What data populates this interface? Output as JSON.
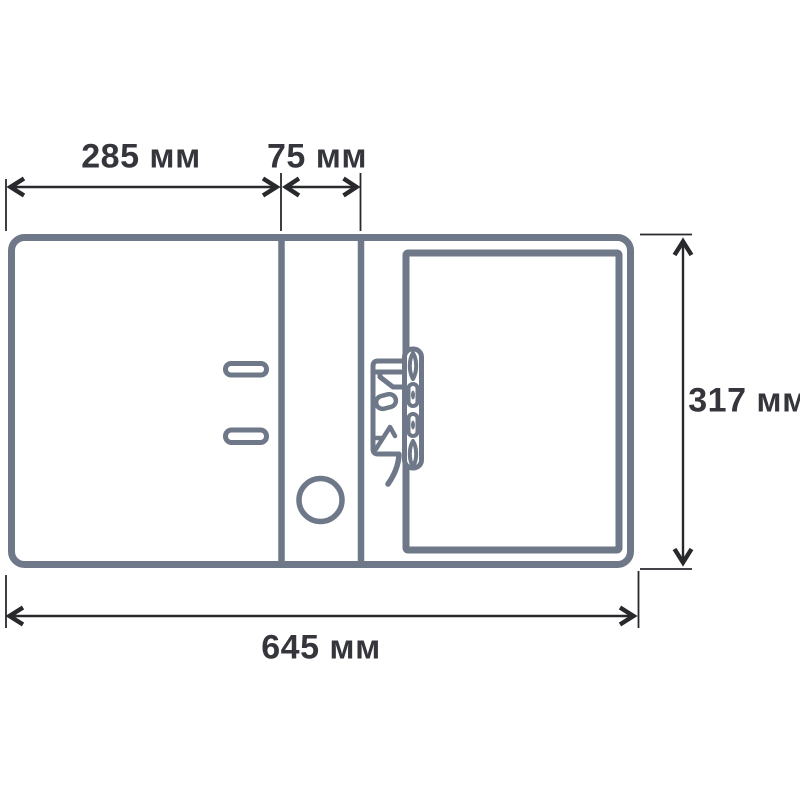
{
  "diagram": {
    "kind": "product-dimension-drawing",
    "subject": "lever-arch-binder-unfolded-outline",
    "dimensions": {
      "cover_width": "285 мм",
      "spine_width": "75 мм",
      "height": "317 мм",
      "total_width": "645 мм"
    },
    "parts": [
      "front-cover-panel",
      "spine-panel",
      "back-cover-panel",
      "inner-cover-panel",
      "spine-label-slot-top",
      "spine-label-slot-bottom",
      "finger-hole",
      "lever-arch-mechanism"
    ],
    "colors": {
      "background": "#ffffff",
      "outline": "#6e7888",
      "dimension_lines": "#28292d",
      "label_text": "#35363c"
    }
  }
}
